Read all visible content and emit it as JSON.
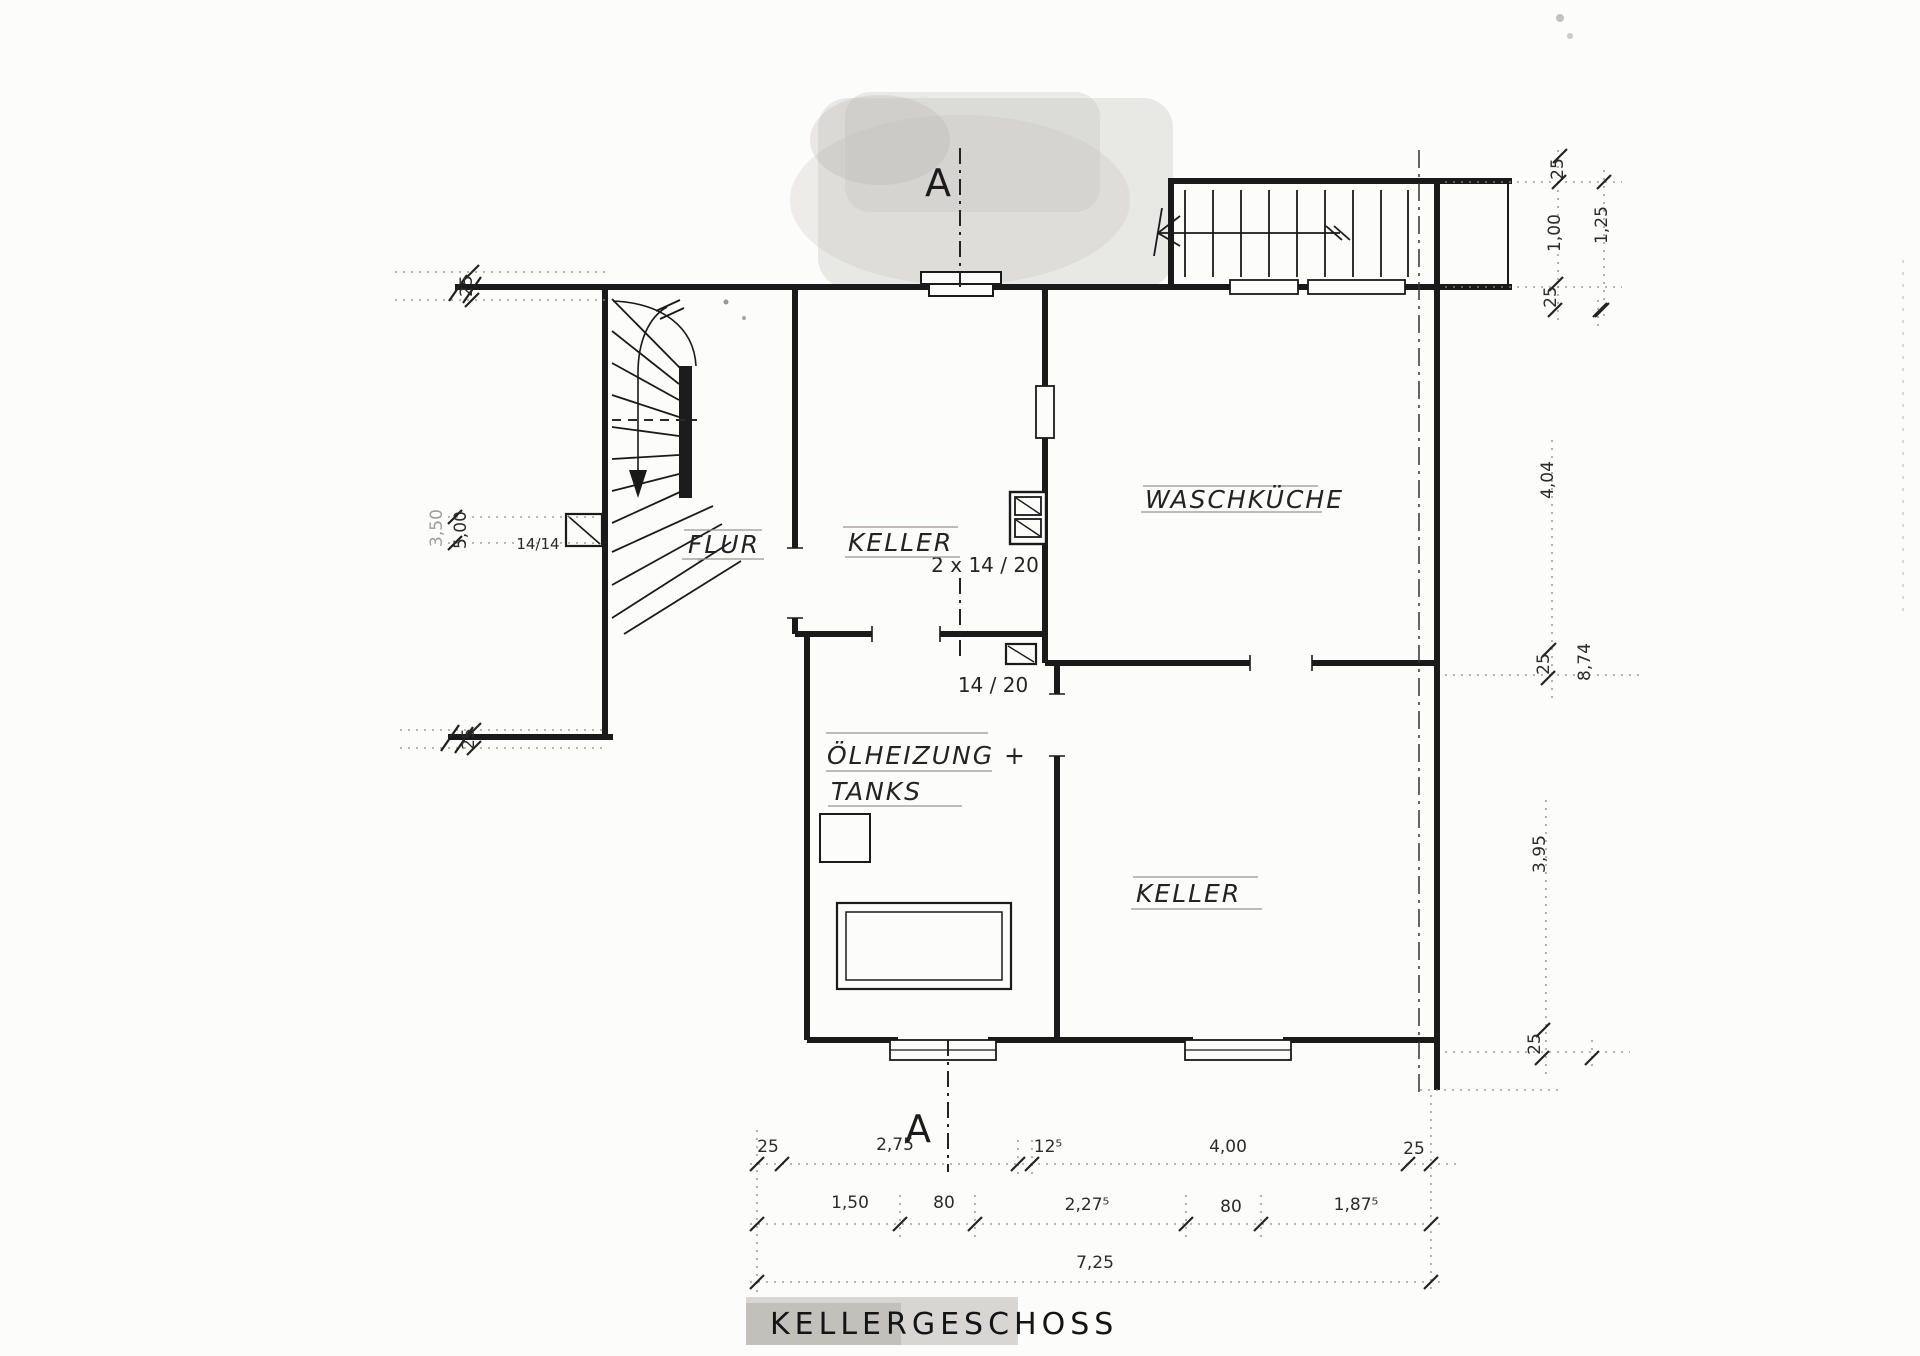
{
  "title": "KELLERGESCHOSS",
  "section": {
    "top_label": "A",
    "bottom_label": "A"
  },
  "rooms": {
    "flur": "FLUR",
    "keller_top": "KELLER",
    "waschkueche": "WASCHKÜCHE",
    "oelheizung_line1": "ÖLHEIZUNG +",
    "oelheizung_line2": "TANKS",
    "keller_bottom": "KELLER"
  },
  "chimneys": {
    "flur": "14/14",
    "keller_top": "2 x 14 / 20",
    "heizraum": "14 / 20"
  },
  "dims": {
    "right": [
      "25",
      "1,00",
      "25",
      "1,25",
      "4,04",
      "25",
      "8,74",
      "3,95",
      "25"
    ],
    "left_top": "25",
    "left_500": "5,00",
    "left_partial": "3,50",
    "left_bottom": "25",
    "row1": [
      "25",
      "2,75",
      "12⁵",
      "4,00",
      "25"
    ],
    "row2": [
      "1,50",
      "80",
      "2,27⁵",
      "80",
      "1,87⁵"
    ],
    "row3": [
      "7,25"
    ]
  },
  "colors": {
    "paper": "#fcfcfa",
    "ink": "#1a1a1a",
    "handwriting_brown": "#5a423e",
    "handwriting_dark": "#34313a",
    "handwriting_grey": "#403a3e",
    "ruled_line": "#9a968f",
    "dim_text": "#2b2b2b"
  }
}
